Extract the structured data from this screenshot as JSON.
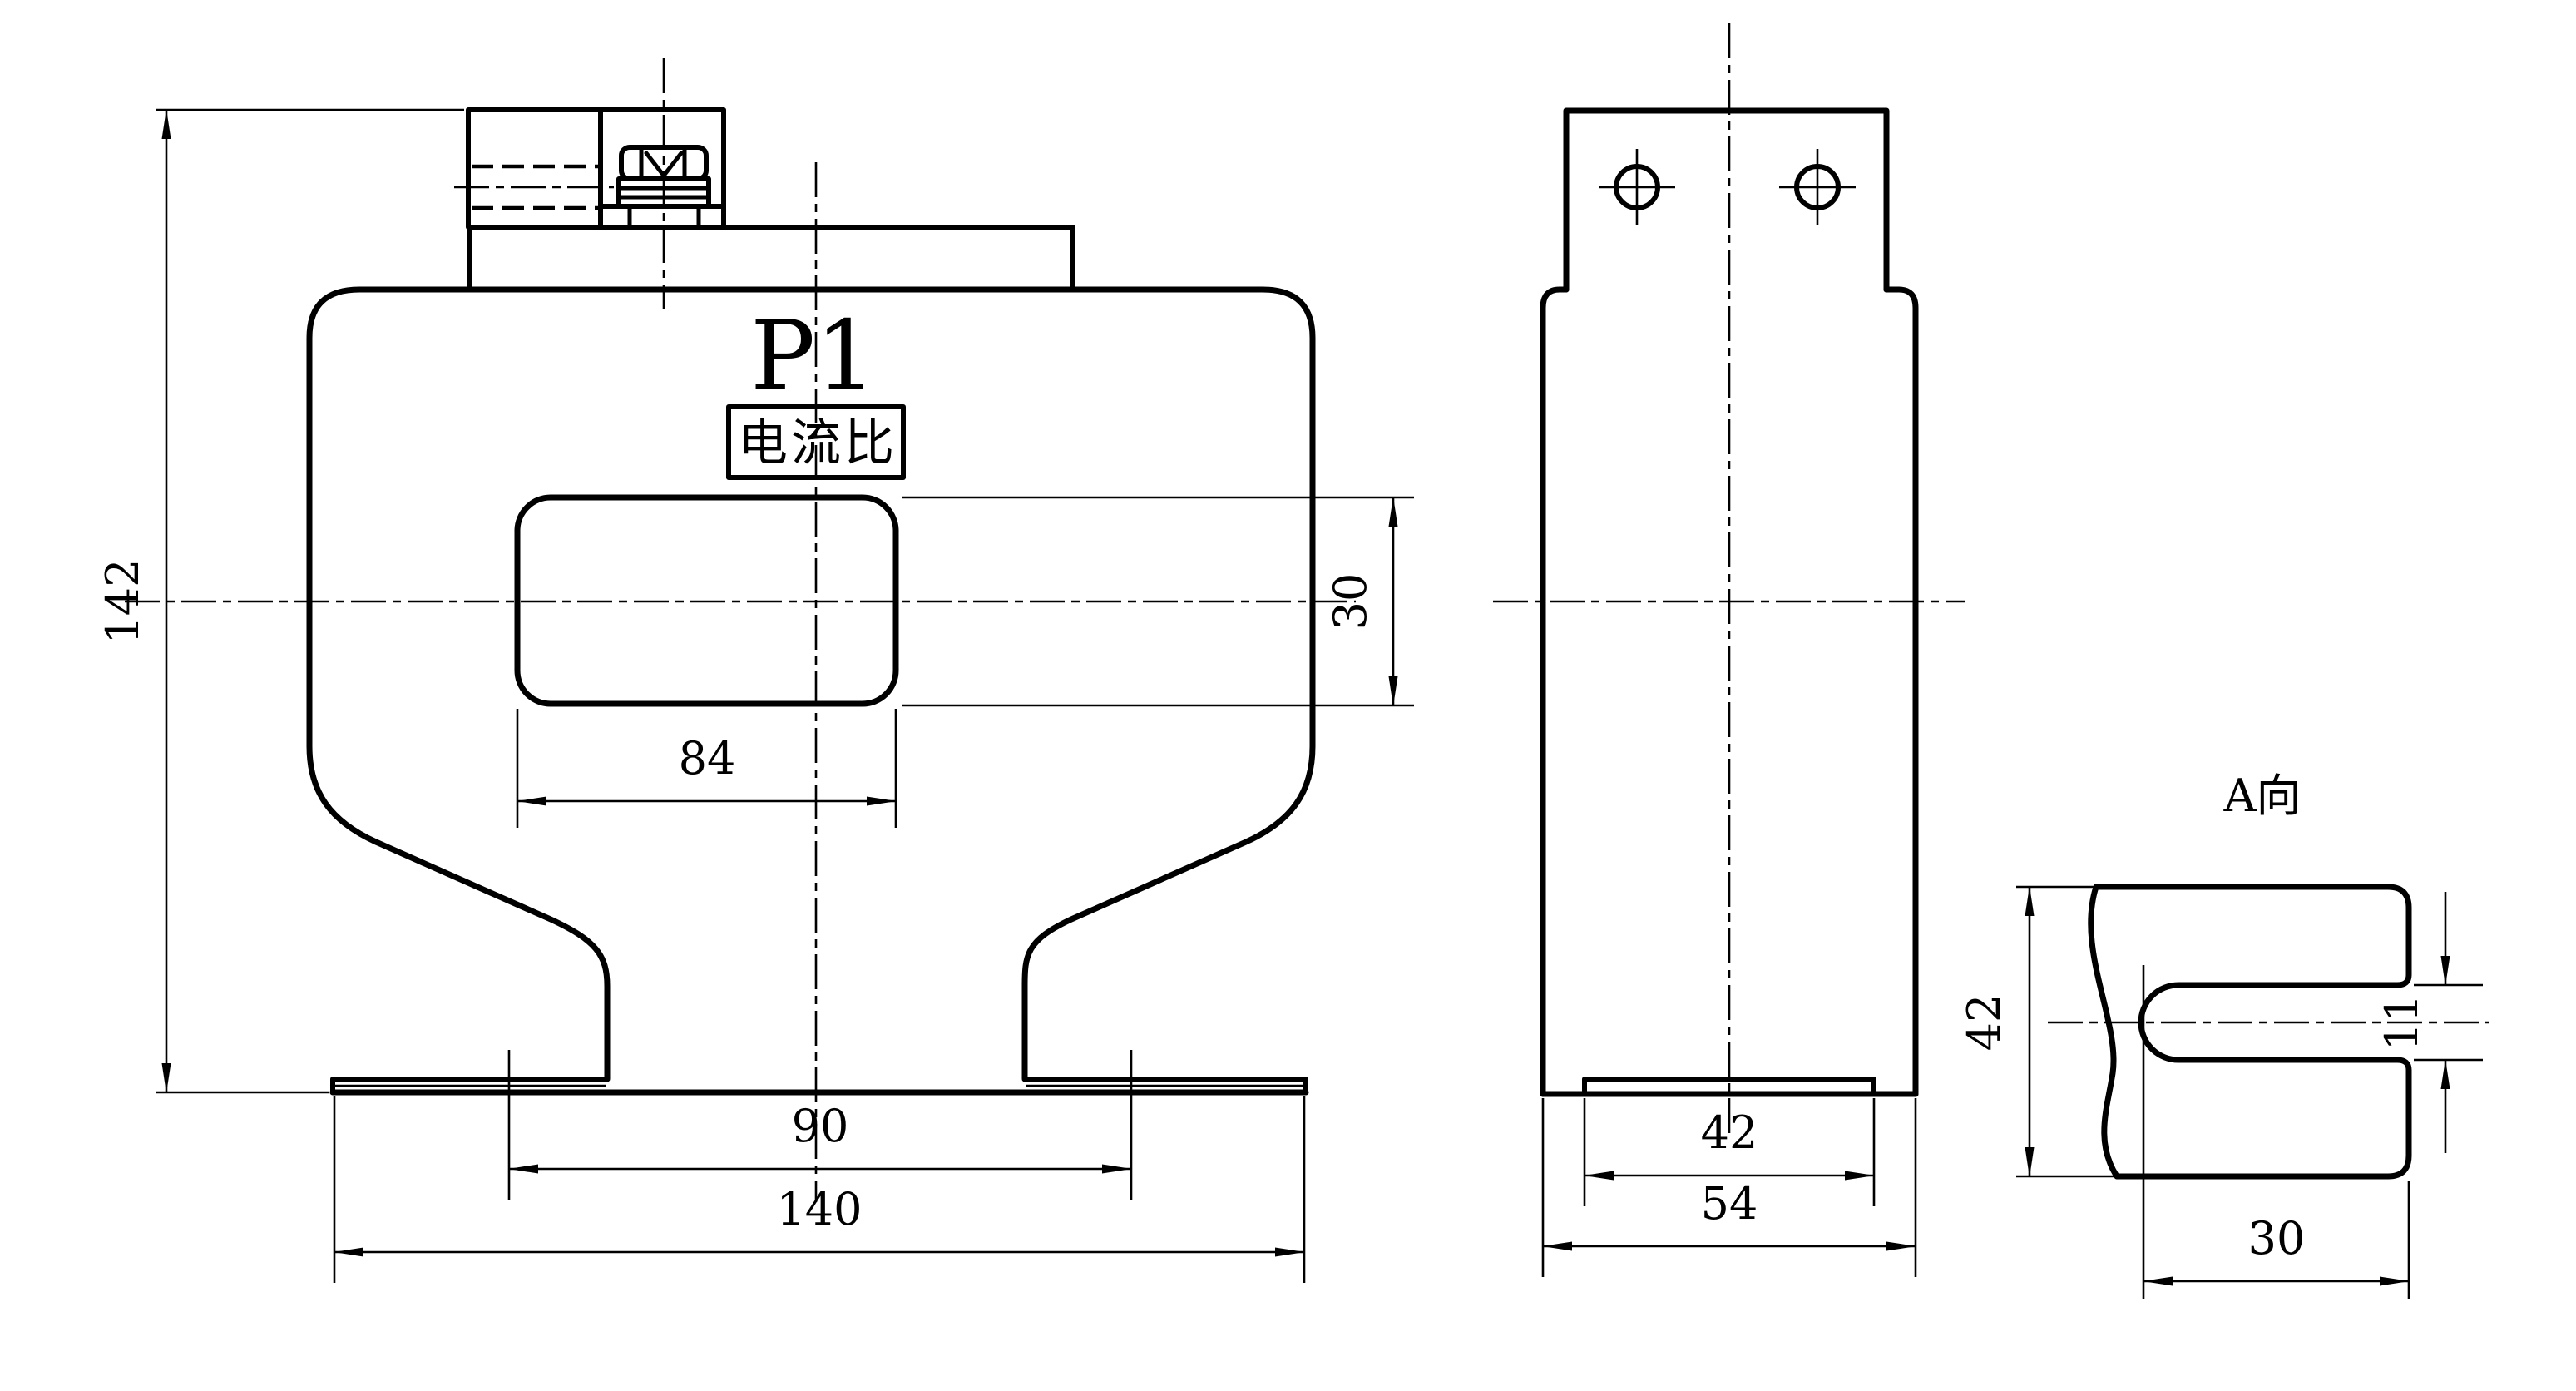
{
  "drawing": {
    "labels": {
      "terminal_marking": "P1",
      "ratio_plate": "电流比",
      "aux_view_title": "A向"
    },
    "front_view": {
      "dim_height": "142",
      "dim_window_width": "84",
      "dim_window_height": "30",
      "dim_slot_centers": "90",
      "dim_base_width": "140"
    },
    "side_view": {
      "dim_base_strip": "42",
      "dim_depth": "54"
    },
    "aux_view": {
      "dim_height": "42",
      "dim_slot_height": "11",
      "dim_slot_depth": "30"
    },
    "colors": {
      "ink": "#000000",
      "paper": "#ffffff"
    }
  }
}
